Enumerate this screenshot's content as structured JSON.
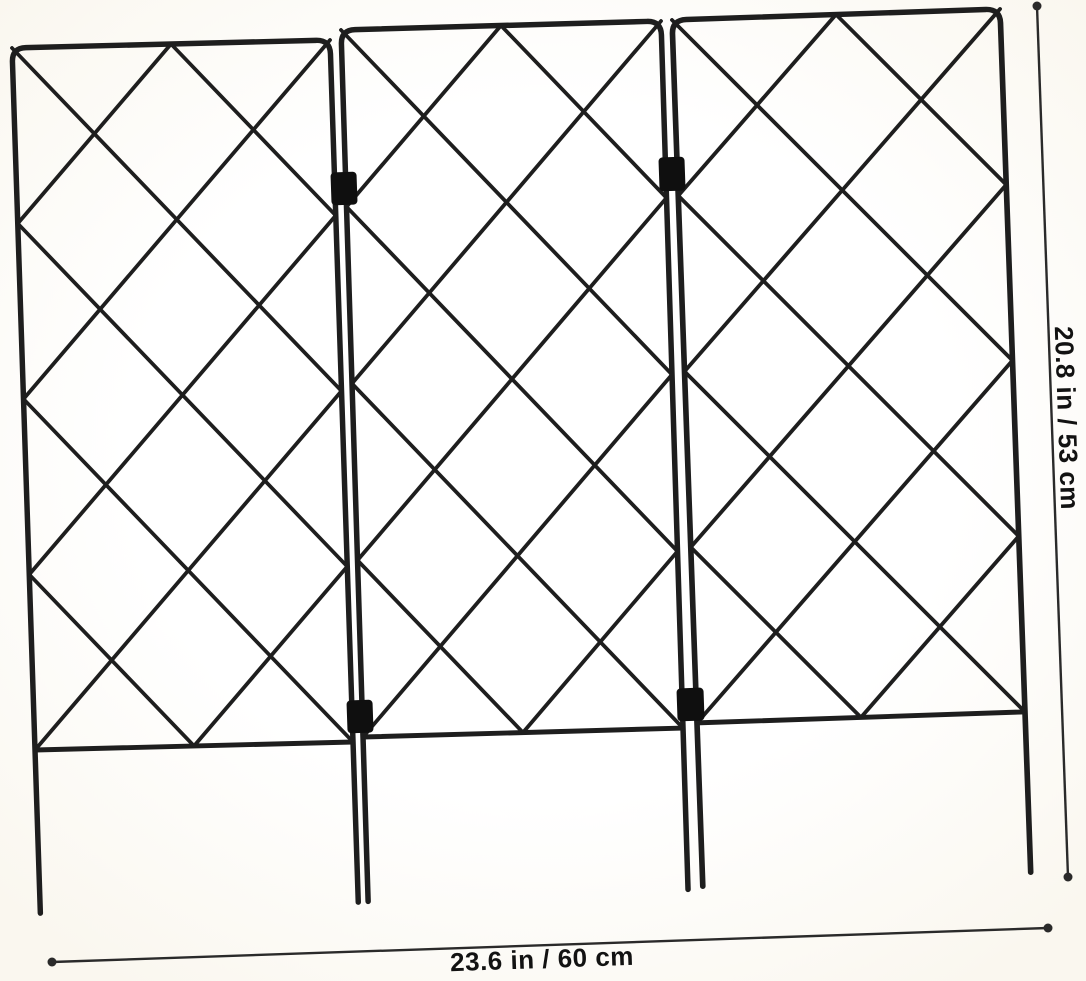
{
  "image": {
    "type": "product-photo",
    "subject": "three-panel folding metal garden trellis with diamond lattice",
    "panel_count": 3
  },
  "dimensions": {
    "width_label": "23.6 in / 60 cm",
    "height_label": "20.8 in / 53 cm"
  },
  "colors": {
    "wire": "#1e1e1e",
    "clip": "#0f0f0f",
    "dim": "#2a2a2a",
    "label": "#121212",
    "bg-edge": "#faf7ef",
    "bg-center": "#ffffff"
  }
}
